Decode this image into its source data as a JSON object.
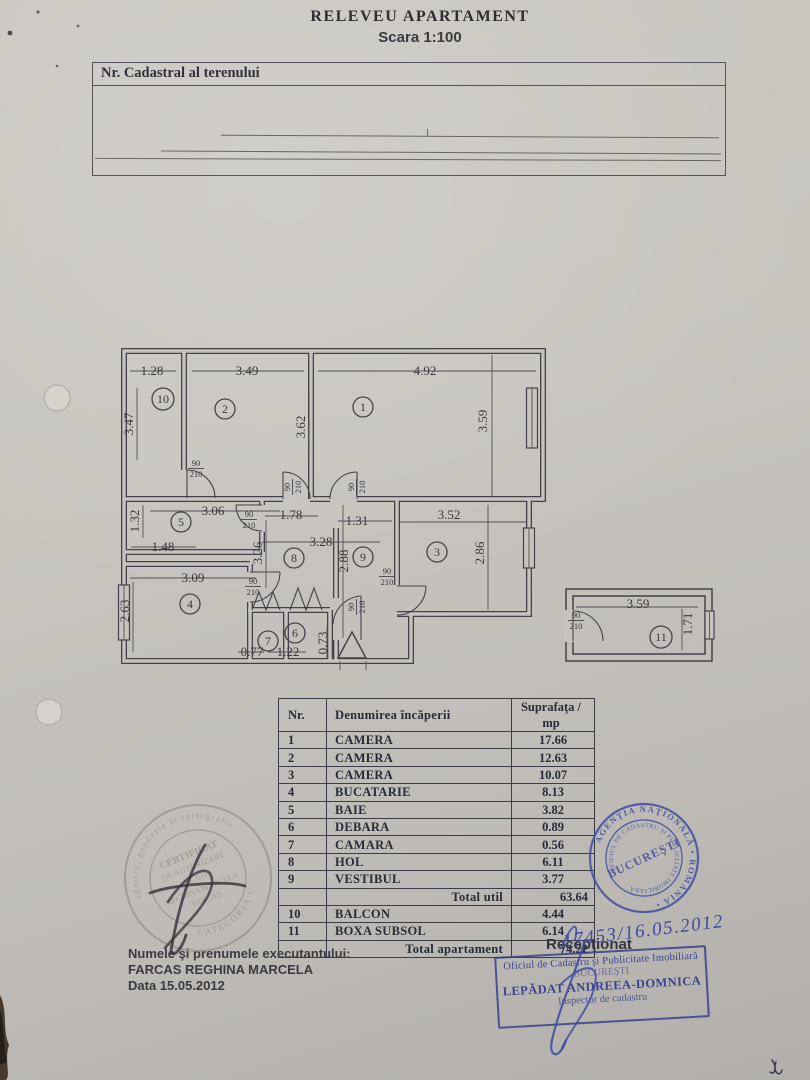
{
  "header": {
    "title": "RELEVEU APARTAMENT",
    "scale": "Scara 1:100"
  },
  "cadastral": {
    "label": "Nr. Cadastral al terenului"
  },
  "plan": {
    "door_w": "90",
    "door_h": "210",
    "room_circles": [
      {
        "n": "10",
        "x": 163,
        "y": 399
      },
      {
        "n": "2",
        "x": 225,
        "y": 409
      },
      {
        "n": "1",
        "x": 363,
        "y": 407
      },
      {
        "n": "5",
        "x": 181,
        "y": 522
      },
      {
        "n": "8",
        "x": 294,
        "y": 558
      },
      {
        "n": "9",
        "x": 363,
        "y": 557
      },
      {
        "n": "3",
        "x": 437,
        "y": 552
      },
      {
        "n": "4",
        "x": 190,
        "y": 604
      },
      {
        "n": "7",
        "x": 268,
        "y": 641
      },
      {
        "n": "6",
        "x": 295,
        "y": 633
      },
      {
        "n": "11",
        "x": 661,
        "y": 637
      }
    ],
    "dims": [
      {
        "t": "1.28",
        "x": 152,
        "y": 375,
        "r": 0
      },
      {
        "t": "3.49",
        "x": 247,
        "y": 375,
        "r": 0
      },
      {
        "t": "4.92",
        "x": 425,
        "y": 375,
        "r": 0
      },
      {
        "t": "3.47",
        "x": 133,
        "y": 424,
        "r": -90
      },
      {
        "t": "3.62",
        "x": 305,
        "y": 427,
        "r": -90
      },
      {
        "t": "3.59",
        "x": 487,
        "y": 421,
        "r": -90
      },
      {
        "t": "3.06",
        "x": 213,
        "y": 515,
        "r": 0
      },
      {
        "t": "1.32",
        "x": 139,
        "y": 521,
        "r": -90
      },
      {
        "t": "1.48",
        "x": 163,
        "y": 551,
        "r": 0
      },
      {
        "t": "1.78",
        "x": 291,
        "y": 519,
        "r": 0
      },
      {
        "t": "1.31",
        "x": 357,
        "y": 525,
        "r": 0
      },
      {
        "t": "3.52",
        "x": 449,
        "y": 519,
        "r": 0
      },
      {
        "t": "3.28",
        "x": 321,
        "y": 546,
        "r": 0
      },
      {
        "t": "3.26",
        "x": 262,
        "y": 553,
        "r": -90
      },
      {
        "t": "2.88",
        "x": 348,
        "y": 561,
        "r": -90
      },
      {
        "t": "2.86",
        "x": 484,
        "y": 553,
        "r": -90
      },
      {
        "t": "3.09",
        "x": 193,
        "y": 582,
        "r": 0
      },
      {
        "t": "2.63",
        "x": 129,
        "y": 611,
        "r": -90
      },
      {
        "t": "0.77",
        "x": 252,
        "y": 656,
        "r": 0
      },
      {
        "t": "1.22",
        "x": 288,
        "y": 656,
        "r": 0
      },
      {
        "t": "0.73",
        "x": 327,
        "y": 643,
        "r": -90
      },
      {
        "t": "3.59",
        "x": 638,
        "y": 608,
        "r": 0
      },
      {
        "t": "1.71",
        "x": 692,
        "y": 624,
        "r": -90
      }
    ],
    "doors": [
      {
        "x": 196,
        "y": 468,
        "r": 0
      },
      {
        "x": 249,
        "y": 519,
        "r": 0
      },
      {
        "x": 292,
        "y": 487,
        "r": -90
      },
      {
        "x": 356,
        "y": 487,
        "r": -90
      },
      {
        "x": 253,
        "y": 586,
        "r": 0
      },
      {
        "x": 356,
        "y": 607,
        "r": -90
      },
      {
        "x": 387,
        "y": 576,
        "r": 0
      },
      {
        "x": 576,
        "y": 620,
        "r": 0
      }
    ]
  },
  "table": {
    "headers": [
      "Nr.",
      "Denumirea încăperii",
      "Suprafaţa / mp"
    ],
    "rows": [
      [
        "1",
        "CAMERA",
        "17.66"
      ],
      [
        "2",
        "CAMERA",
        "12.63"
      ],
      [
        "3",
        "CAMERA",
        "10.07"
      ],
      [
        "4",
        "BUCATARIE",
        "8.13"
      ],
      [
        "5",
        "BAIE",
        "3.82"
      ],
      [
        "6",
        "DEBARA",
        "0.89"
      ],
      [
        "7",
        "CAMARA",
        "0.56"
      ],
      [
        "8",
        "HOL",
        "6.11"
      ],
      [
        "9",
        "VESTIBUL",
        "3.77"
      ],
      {
        "total": true,
        "label": "Total util",
        "value": "63.64"
      },
      [
        "10",
        "BALCON",
        "4.44"
      ],
      [
        "11",
        "BOXA SUBSOL",
        "6.14"
      ],
      {
        "total": true,
        "label": "Total apartament",
        "value": "74.22"
      }
    ]
  },
  "footer": {
    "executant_label": "Numele şi prenumele executantului:",
    "executant_name": "FARCAS REGHINA MARCELA",
    "date": "Data 15.05.2012",
    "receptionat": "Recepţionat",
    "handwritten_number": "17453/16.05.2012"
  },
  "stamps": {
    "rect": {
      "line1": "Oficiul de Cadastru şi Publicitate Imobiliară",
      "line2": "BUCUREŞTI",
      "line3": "LEPĂDAT ANDREEA-DOMNICA",
      "line4": "Inspector de cadastru"
    },
    "round_right": {
      "ring_outer": "AGENŢIA NAŢIONALĂ  •  ROMÂNIA  •",
      "ring_inner": "OFICIUL DE CADASTRU ŞI PUBLICITATE IMOBILIARĂ",
      "center": "BUCUREŞTI"
    },
    "round_left": {
      "ring_top": "de cadastru, geodezie şi cartografie",
      "ring_bottom": "CATEGORIA C",
      "line1": "CERTIFICAT",
      "line2": "DE AUTORIZARE",
      "line3": "Nr. 0119",
      "line4": "REGHINA MARCELA",
      "line5": "FARCAŞ"
    }
  }
}
